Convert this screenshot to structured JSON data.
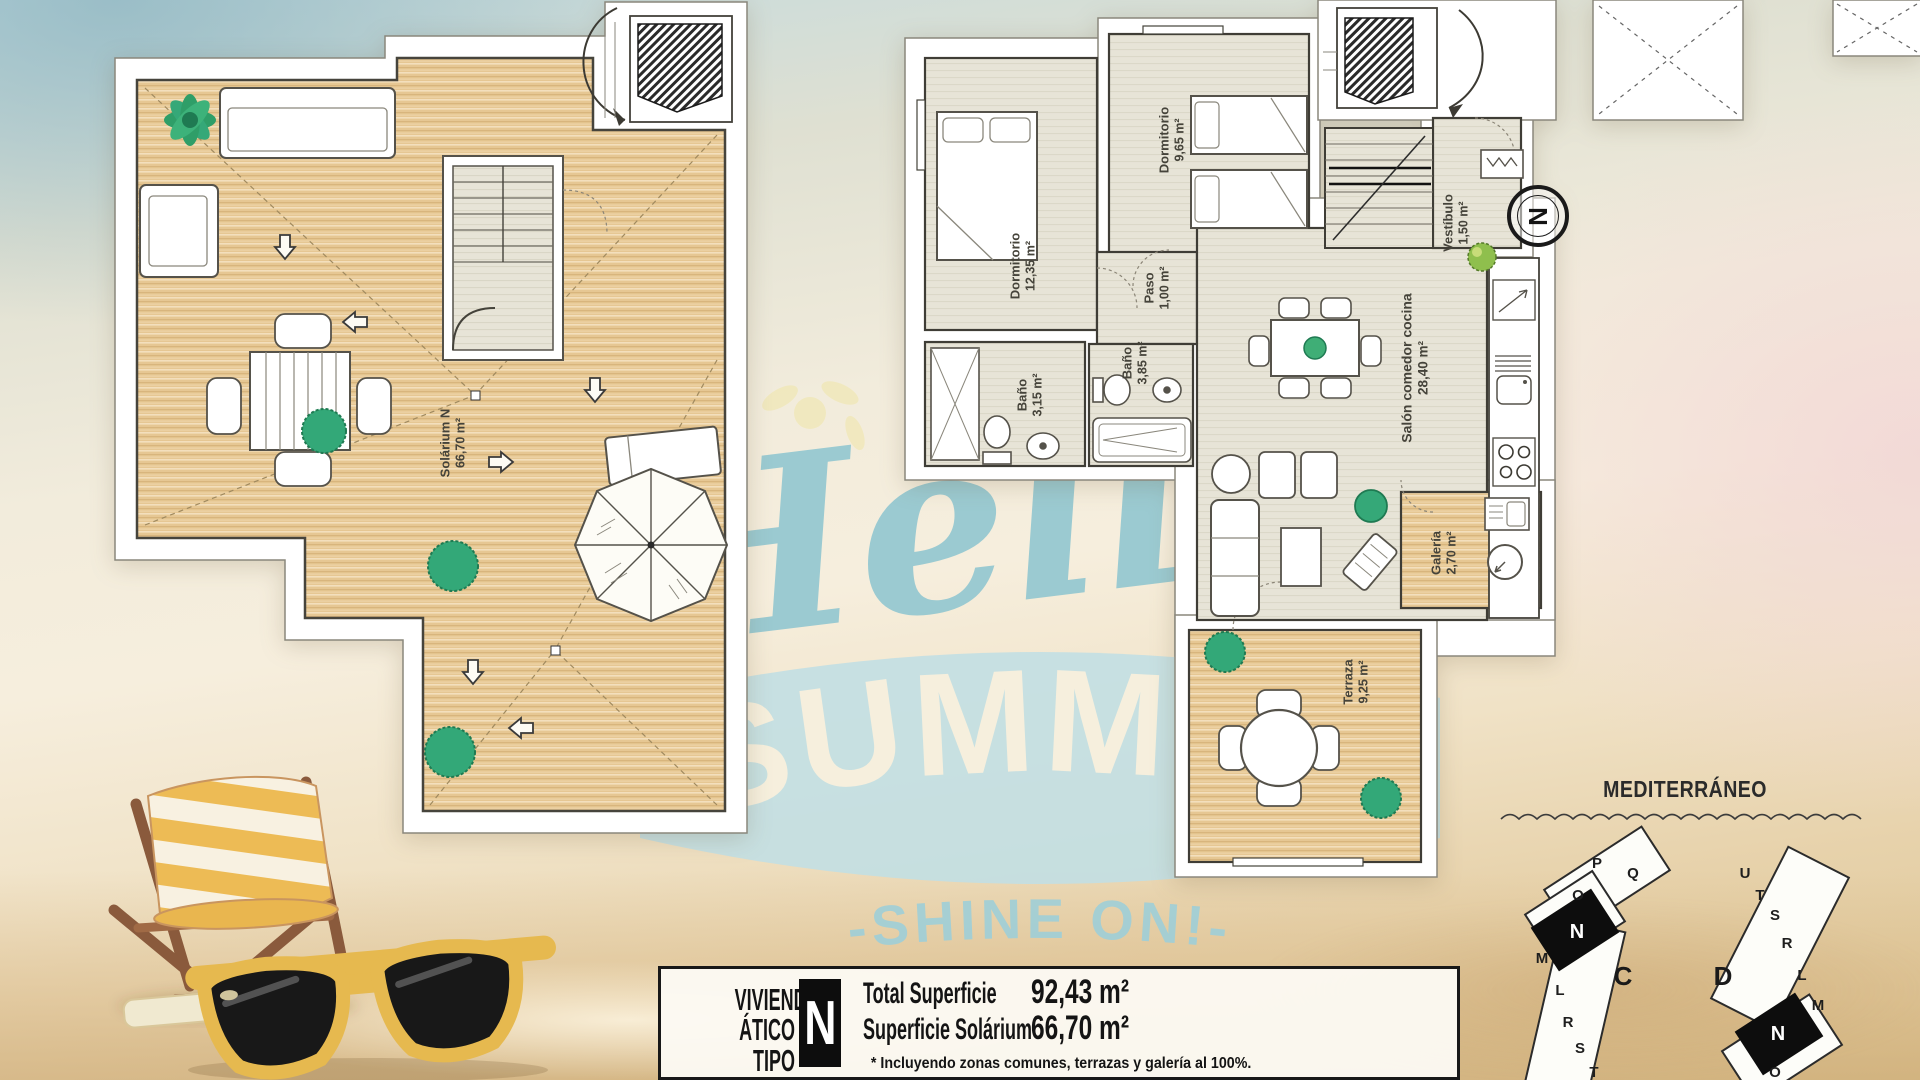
{
  "watermark": {
    "script": "Hello",
    "band": "SUMMER",
    "tagline": "-SHINE ON!-"
  },
  "left_plan": {
    "label_name": "Solárium N",
    "label_area": "66,70 m²"
  },
  "right_plan": {
    "compass": "N",
    "rooms": [
      {
        "name": "Dormitorio",
        "area": "12,35 m²"
      },
      {
        "name": "Dormitorio",
        "area": "9,65 m²"
      },
      {
        "name": "Paso",
        "area": "1,00 m²"
      },
      {
        "name": "Baño",
        "area": "3,15 m²"
      },
      {
        "name": "Baño",
        "area": "3,85 m²"
      },
      {
        "name": "Salón comedor cocina",
        "area": "28,40 m²"
      },
      {
        "name": "Vestíbulo",
        "area": "1,50 m²"
      },
      {
        "name": "Galería",
        "area": "2,70 m²"
      },
      {
        "name": "Terraza",
        "area": "9,25 m²"
      }
    ]
  },
  "info_box": {
    "title_line1": "VIVIENDA",
    "title_line2": "ÁTICO TIPO",
    "type_letter": "N",
    "total_label": "Total Superficie",
    "total_value": "92,43 m²",
    "solarium_label": "Superficie Solárium",
    "solarium_value": "66,70 m²",
    "footnote": "* Incluyendo zonas comunes, terrazas y galería al 100%."
  },
  "site_plan": {
    "sea_label": "MEDITERRÁNEO",
    "block_c": {
      "label": "C",
      "units": [
        "P",
        "Q",
        "O",
        "N",
        "M",
        "L",
        "R",
        "S",
        "T"
      ],
      "highlighted_unit": "N"
    },
    "block_d": {
      "label": "D",
      "units": [
        "U",
        "T",
        "S",
        "R",
        "L",
        "M",
        "N",
        "O"
      ],
      "highlighted_unit": "N"
    }
  },
  "colors": {
    "watermark_teal": "#8fc6d0",
    "band_teal": "#c2dfe3",
    "deck_wood": "#e6c793",
    "interior_floor": "#e7e4d7",
    "accent_black": "#141414",
    "plant_green": "#35a878",
    "sunglasses_yellow": "#e6b94f"
  }
}
